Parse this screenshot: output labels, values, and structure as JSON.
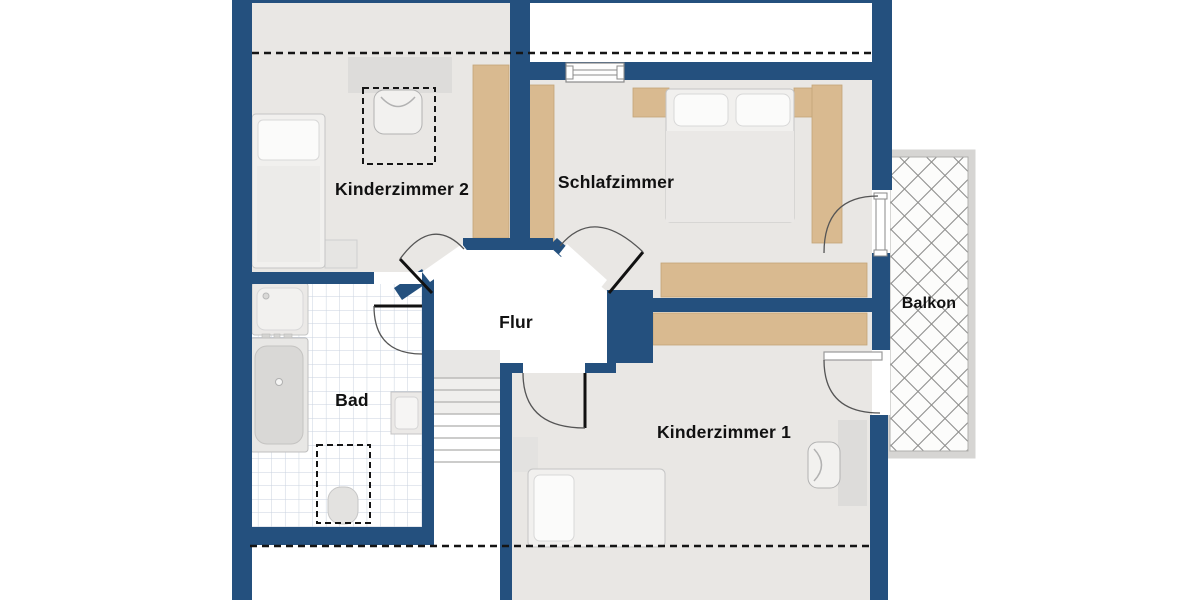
{
  "plan": {
    "type": "floor-plan",
    "rooms": {
      "kinderzimmer2": {
        "label": "Kinderzimmer 2"
      },
      "schlafzimmer": {
        "label": "Schlafzimmer"
      },
      "flur": {
        "label": "Flur"
      },
      "bad": {
        "label": "Bad"
      },
      "kinderzimmer1": {
        "label": "Kinderzimmer 1"
      },
      "balkon": {
        "label": "Balkon"
      }
    },
    "colors": {
      "wall": "#24507e",
      "floor": "#e9e7e4",
      "furniture_wood": "#d9ba90",
      "furniture_gray": "#e2e1df",
      "tile_line": "#c9d2df",
      "hatch_line": "#8f8f8d",
      "dashed_line": "#151515",
      "text": "#111111",
      "background": "#ffffff"
    }
  }
}
